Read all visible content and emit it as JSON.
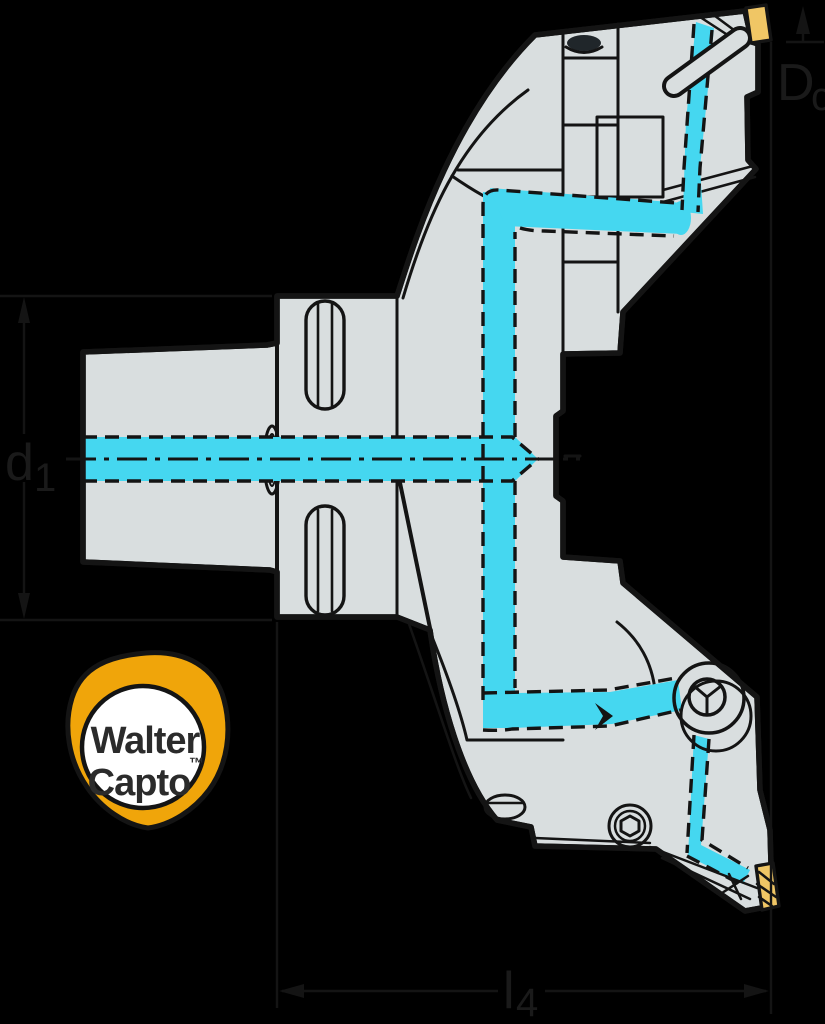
{
  "diagram": {
    "type": "technical-drawing",
    "subject": "Walter Capto face milling cutter cross-section with internal coolant supply",
    "dimension_labels": {
      "d1": {
        "main": "d",
        "sub": "1"
      },
      "dc": {
        "main": "D",
        "sub": "c"
      },
      "l4": {
        "main": "l",
        "sub": "4"
      }
    },
    "badge": {
      "line1": "Walter",
      "line2": "Capto",
      "trademark": "™"
    },
    "colors": {
      "background": "#000000",
      "body_fill": "#d9dedf",
      "line": "#141414",
      "coolant": "#45d7f0",
      "insert": "#f0c665",
      "badge_ring": "#f0a50a",
      "badge_text": "#2b2b2b",
      "screw_dark": "#20262a"
    }
  }
}
